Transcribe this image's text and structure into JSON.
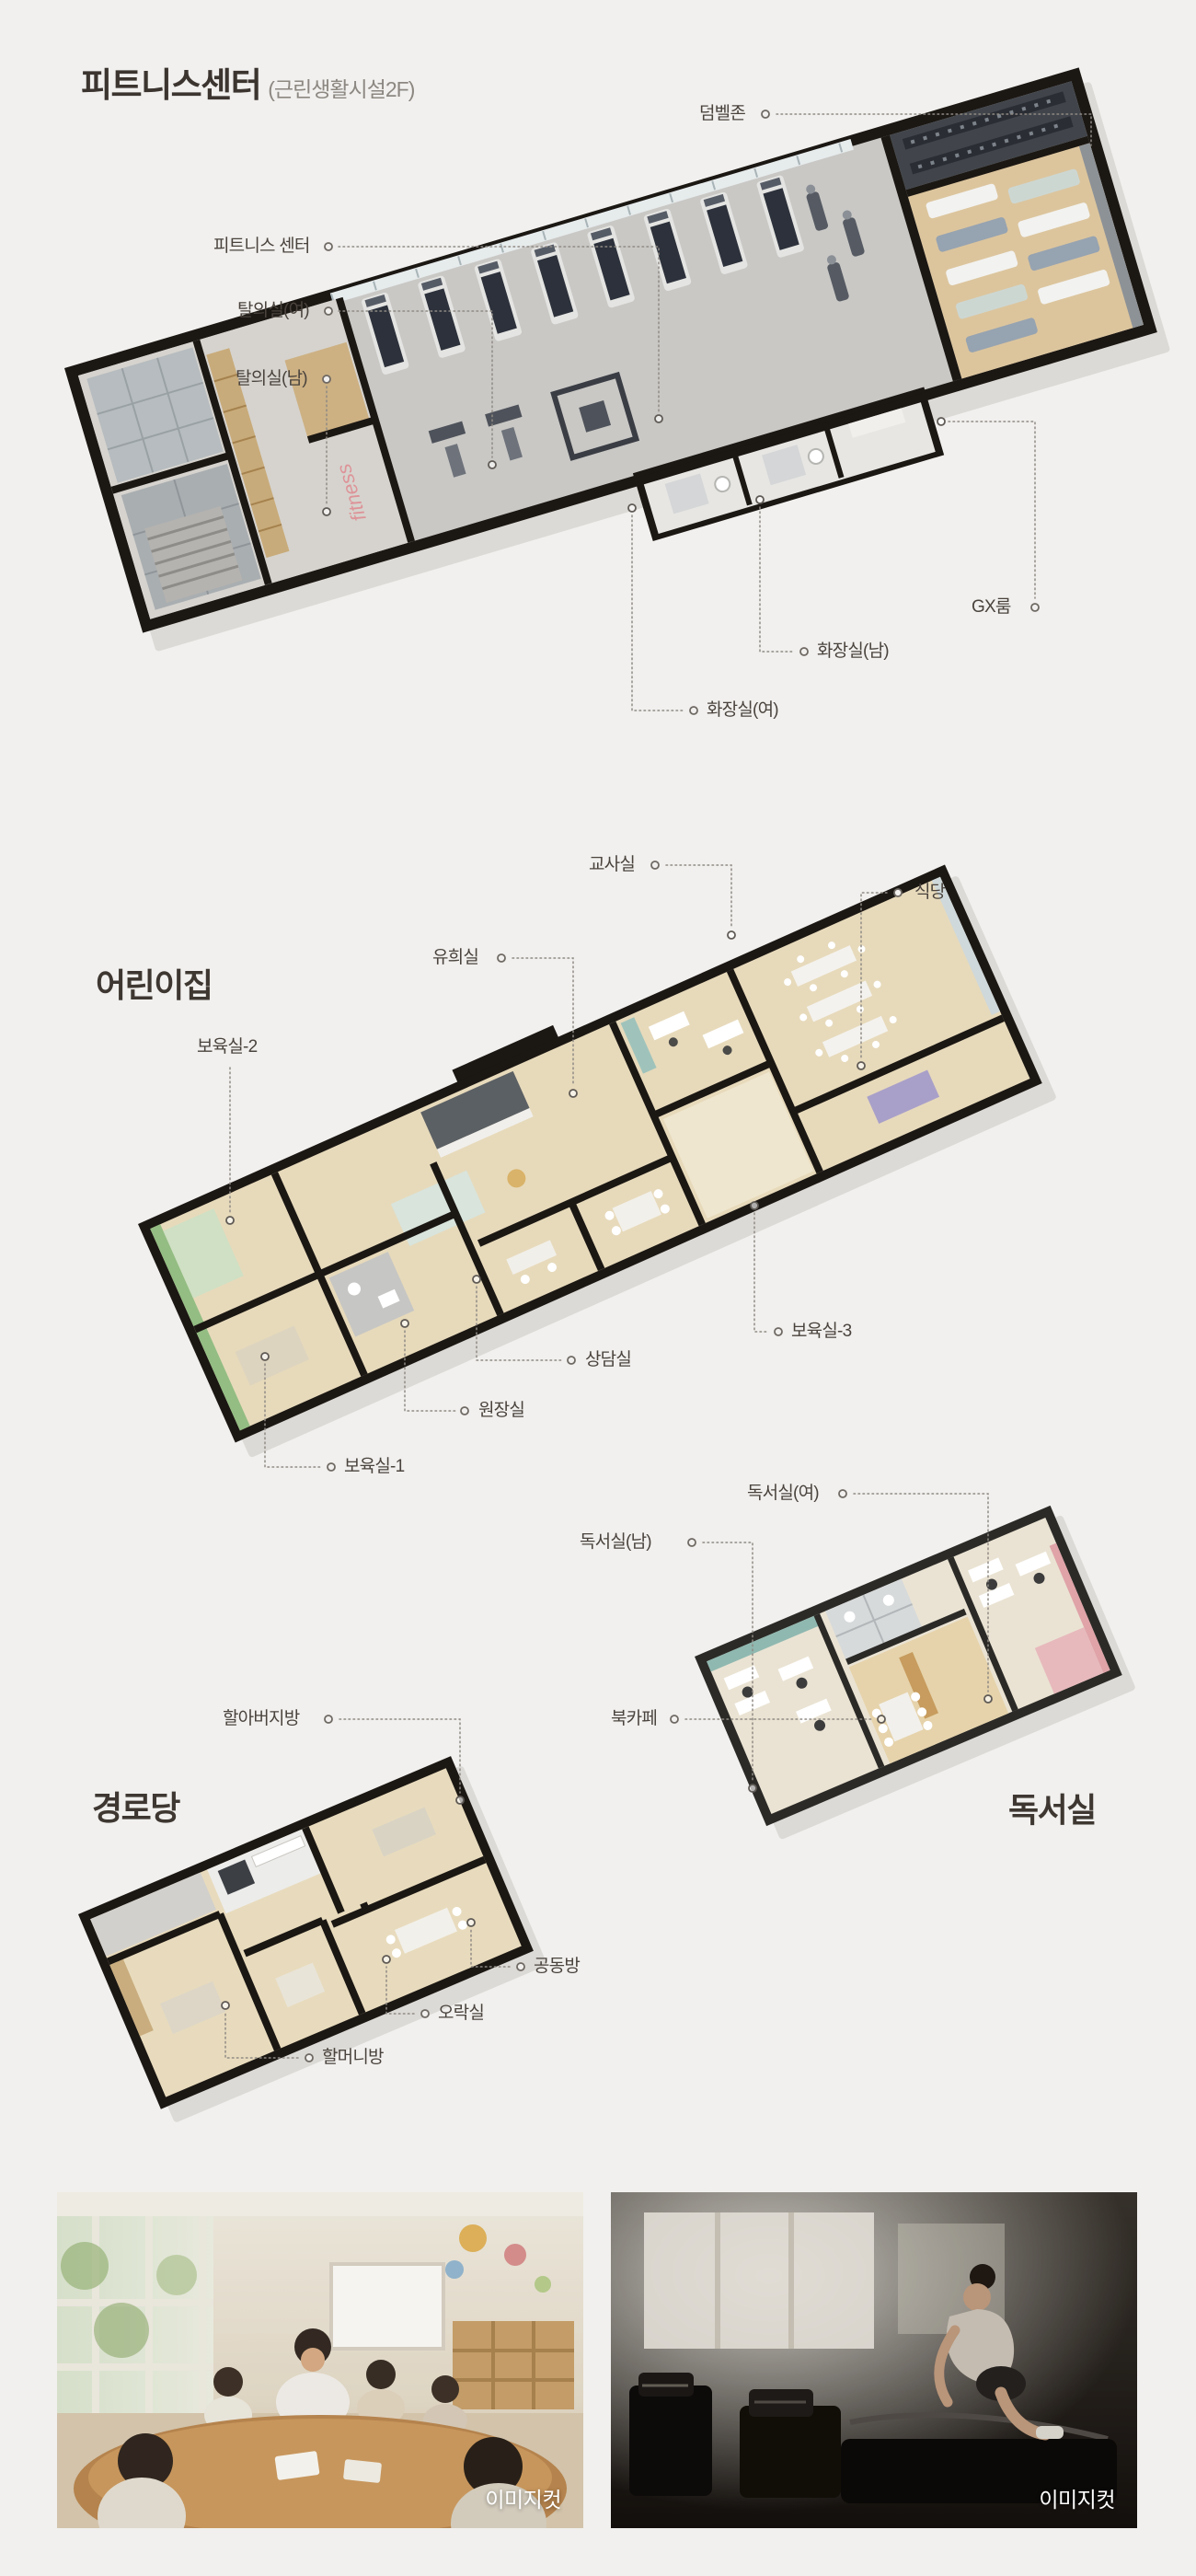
{
  "fitness": {
    "title": "피트니스센터",
    "subtitle": "(근린생활시설2F)",
    "wall_text": "fitness",
    "labels": {
      "dumbbell_zone": "덤벨존",
      "fitness_center": "피트니스 센터",
      "locker_women": "탈의실(여)",
      "locker_men": "탈의실(남)",
      "gx_room": "GX룸",
      "toilet_men": "화장실(남)",
      "toilet_women": "화장실(여)"
    }
  },
  "daycare": {
    "title": "어린이집",
    "labels": {
      "teachers_room": "교사실",
      "dining_room": "식당",
      "play_room": "유희실",
      "care_room_2": "보육실-2",
      "care_room_3": "보육실-3",
      "counsel_room": "상담실",
      "directors_room": "원장실",
      "care_room_1": "보육실-1"
    }
  },
  "reading": {
    "title": "독서실",
    "labels": {
      "reading_women": "독서실(여)",
      "reading_men": "독서실(남)",
      "book_cafe": "북카페"
    }
  },
  "senior": {
    "title": "경로당",
    "labels": {
      "grandfather_room": "할아버지방",
      "common_room": "공동방",
      "recreation_room": "오락실",
      "grandmother_room": "할머니방"
    }
  },
  "photos": {
    "daycare_caption": "이미지컷",
    "gym_caption": "이미지컷"
  },
  "colors": {
    "background": "#f1f0ee",
    "title_text": "#3b342f",
    "subtitle_text": "#8c8781",
    "label_text": "#4a433d",
    "leader_line": "#8f8a84",
    "wall": "#1b1713",
    "wood_floor": "#e7dabb",
    "gym_floor": "#c9c8c5",
    "gx_floor": "#dcc59d",
    "accent_green": "#93bd83",
    "accent_teal": "#8fb8b0",
    "accent_pink": "#dfa3a8",
    "fitness_sign": "#dd9398"
  }
}
